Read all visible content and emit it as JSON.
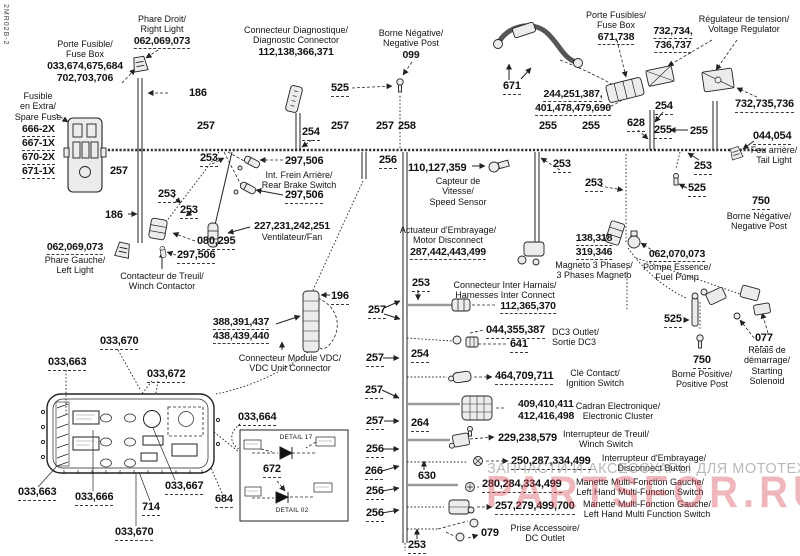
{
  "page": {
    "doc_code": "2MR02B-2"
  },
  "watermark": {
    "gray_text": "ЗАПЧАСТИ И АКСЕССУАРЫ ДЛЯ МОТОТЕХНИКИ",
    "red_text": "PARTSFOR.RU",
    "gray_color": "#808080",
    "red_color": "#d84c57"
  },
  "co": {
    "186": "186",
    "196": "196",
    "253": "253",
    "254": "254",
    "255": "255",
    "256": "256",
    "257": "257",
    "258": "258",
    "264": "264",
    "266": "266",
    "525": "525",
    "628": "628",
    "630": "630"
  },
  "labels": {
    "fuse_box_main": {
      "fr": "Porte Fusible/",
      "en": "Fuse Box",
      "n1": "033,674,675,684",
      "n2": "702,703,706"
    },
    "right_light": {
      "fr": "Phare Droit/",
      "en": "Right Light",
      "n": "062,069,073"
    },
    "diag_connector": {
      "fr": "Connecteur Diagnostique/",
      "en": "Diagnostic Connector",
      "n": "112,138,366,371"
    },
    "neg_post_top": {
      "fr": "Borne Négative/",
      "en": "Negative Post",
      "n": "099"
    },
    "fuse_box_right": {
      "fr": "Porte Fusibles/",
      "en": "Fuse Box",
      "n": "671,738"
    },
    "voltage_regulator": {
      "fr": "Régulateur de tension/",
      "en": "Voltage Regulator",
      "n1": "732,734,",
      "n2": "736,737",
      "n3": "732,735,736"
    },
    "spare_fuse": {
      "l1": "Fusible",
      "l2": "en Extra/",
      "l3": "Spare Fuse",
      "f1": "666-2X",
      "f2": "667-1X",
      "f3": "670-2X",
      "f4": "671-1X"
    },
    "main_harness": {
      "n1": "671",
      "n2": "244,251,387,",
      "n3": "401,478,479,690"
    },
    "tail_light": {
      "n": "044,054",
      "fr": "Feu arrière/",
      "en": "Tail Light"
    },
    "neg_post_right": {
      "n": "750",
      "fr": "Borne Négative/",
      "en": "Negative Post"
    },
    "fuel_pump": {
      "n": "062,070,073",
      "fr": "Pompe Essence/",
      "en": "Fuel Pump"
    },
    "magneto": {
      "n1": "138,318",
      "n2": "319,346",
      "fr": "Magneto 3 Phases/",
      "en": "3 Phases Magneto"
    },
    "speed_sensor": {
      "n": "110,127,359",
      "fr1": "Capteur de",
      "fr2": "Vitesse/",
      "en": "Speed Sensor"
    },
    "motor_disconnect": {
      "fr": "Actuateur d'Embrayage/",
      "en": "Motor Disconnect",
      "n": "287,442,443,499"
    },
    "rear_brake_switch": {
      "n1": "297,506",
      "fr": "Int. Frein Arrière/",
      "en": "Rear Brake Switch",
      "n2": "297,506"
    },
    "fan": {
      "n": "227,231,242,251",
      "fren": "Ventilateur/Fan"
    },
    "left_light": {
      "n": "062,069,073",
      "fr": "Phare Gauche/",
      "en": "Left Light"
    },
    "winch_contactor": {
      "fr": "Contacteur de Treuil/",
      "en": "Winch Contactor",
      "n1": "080,295",
      "n2": "297,506"
    },
    "vdc_connector": {
      "n1": "388,391,437",
      "n2": "438,439,440",
      "fr": "Connecteur Module VDC/",
      "en": "VDC Unit Connector"
    },
    "inter_harness": {
      "fr": "Connecteur Inter Harnais/",
      "en": "Harnesses Inter Connect",
      "n": "112,365,370"
    },
    "dc3_outlet": {
      "n1": "044,355,387",
      "n2": "641",
      "en": "DC3 Outlet/",
      "fr": "Sortie DC3"
    },
    "ignition_switch": {
      "n": "464,709,711",
      "fr": "Clé Contact/",
      "en": "Ignition Switch"
    },
    "electronic_cluster": {
      "n1": "409,410,411",
      "n2": "412,416,498",
      "fr": "Cadran Electronique/",
      "en": "Electronic Cluster"
    },
    "winch_switch": {
      "n": "229,238,579",
      "fr": "Interrupteur de Treuil/",
      "en": "Winch Switch"
    },
    "disconnect_button": {
      "n": "250,287,334,499",
      "fr": "Interrupteur d'Embrayage/",
      "en": "Disconnect Button"
    },
    "lh_multifunction_gauge": {
      "n": "280,284,334,499",
      "fr": "Manette Multi-Fonction Gauche/",
      "en": "Left Hand Multi-Function Switch"
    },
    "lh_multifunction_switch": {
      "n": "257,279,499,700",
      "fr": "Manette Multi-Fonction Gauche/",
      "en": "Left Hand Multi Function Switch"
    },
    "dc_outlet_bottom": {
      "n": "079",
      "fr": "Prise Accessoire/",
      "en": "DC Outlet"
    },
    "starting_solenoid": {
      "n": "077",
      "l1": "Relais de",
      "l2": "démarrage/",
      "l3": "Starting",
      "l4": "Solenoid"
    },
    "pos_post": {
      "n": "750",
      "fr": "Borne Positive/",
      "en": "Positive Post"
    },
    "cluster_detail": {
      "top": "033,670",
      "l663a": "033,663",
      "l672": "033,672",
      "l664": "033,664",
      "l663b": "033,663",
      "l666": "033,666",
      "l667": "033,667",
      "l684": "684",
      "l714": "714",
      "bottom": "033,670",
      "d672": "672",
      "detail_top": "DETAIL 17",
      "detail_bottom": "DETAIL 02"
    }
  }
}
